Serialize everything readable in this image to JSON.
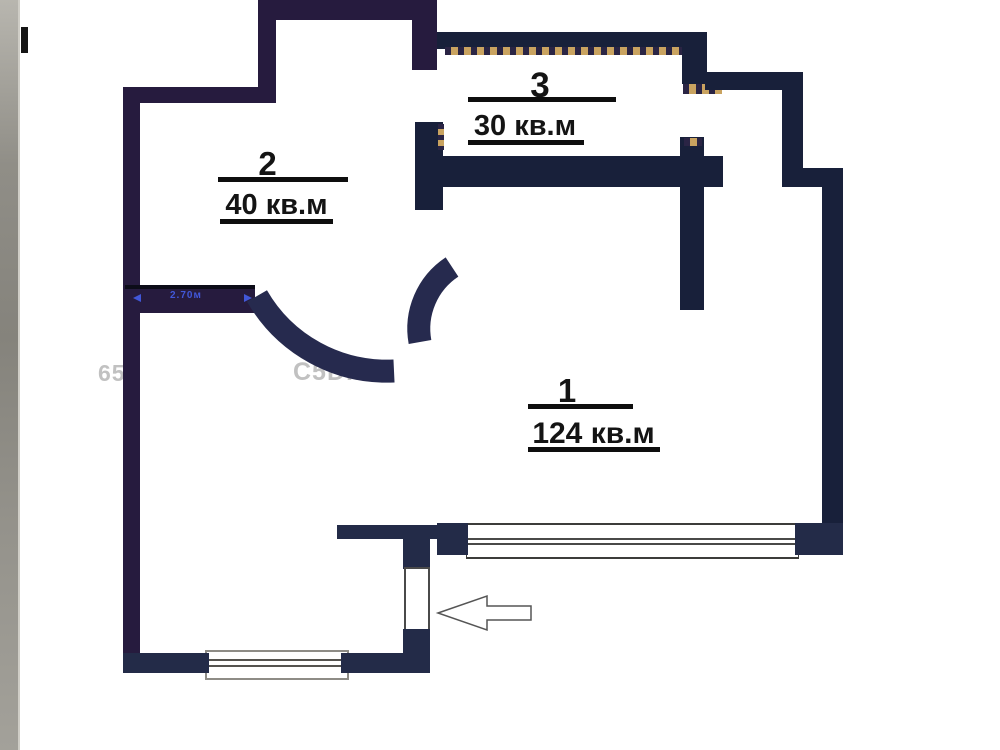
{
  "floor_plan": {
    "rooms": [
      {
        "number": "1",
        "area": "124 кв.м"
      },
      {
        "number": "2",
        "area": "40 кв.м"
      },
      {
        "number": "3",
        "area": "30 кв.м"
      }
    ],
    "wall_dimension": "2.70м",
    "watermarks": {
      "left": "65",
      "right": "С5D.RU"
    }
  },
  "colors": {
    "wall_purple": "#261b3e",
    "wall_navy": "#232b48",
    "wall_deep": "#18203a",
    "hatch_tan": "#c9a360",
    "dimension_blue": "#4157d8",
    "label_black": "#141414"
  }
}
